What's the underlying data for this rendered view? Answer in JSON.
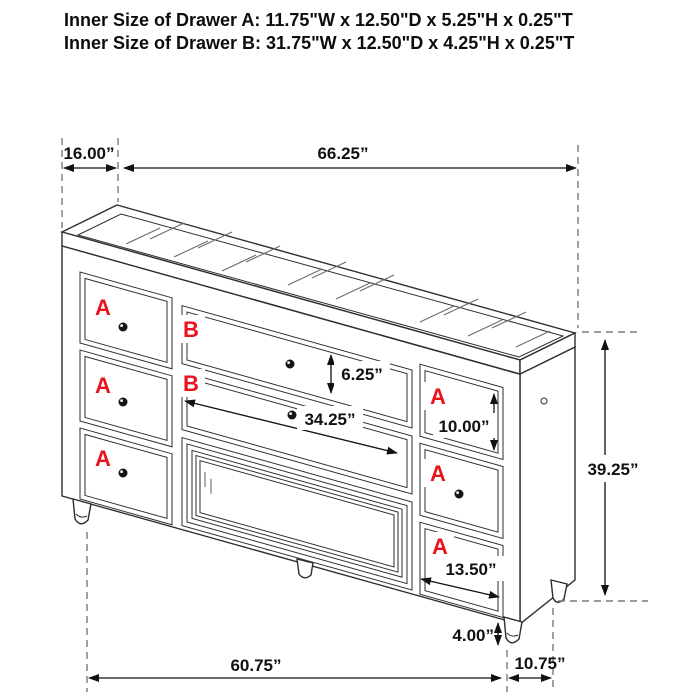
{
  "header": {
    "line1": "Inner Size of Drawer A: 11.75\"W x 12.50\"D x 5.25\"H x 0.25\"T",
    "line2": "Inner Size of Drawer B: 31.75\"W x 12.50\"D x 4.25\"H x 0.25\"T"
  },
  "drawer_labels": {
    "a": "A",
    "b": "B"
  },
  "dimensions": {
    "top_depth": "16.00”",
    "top_width": "66.25”",
    "drawer_b_height": "6.25”",
    "drawer_b_width": "34.25”",
    "drawer_a_right_height": "10.00”",
    "overall_height": "39.25”",
    "drawer_a_right_width": "13.50”",
    "leg_height": "4.00”",
    "base_width": "60.75”",
    "base_depth": "10.75”"
  },
  "colors": {
    "line": "#2e2e2e",
    "dimension_text": "#111111",
    "label_red": "#e8131b",
    "background": "#ffffff"
  }
}
